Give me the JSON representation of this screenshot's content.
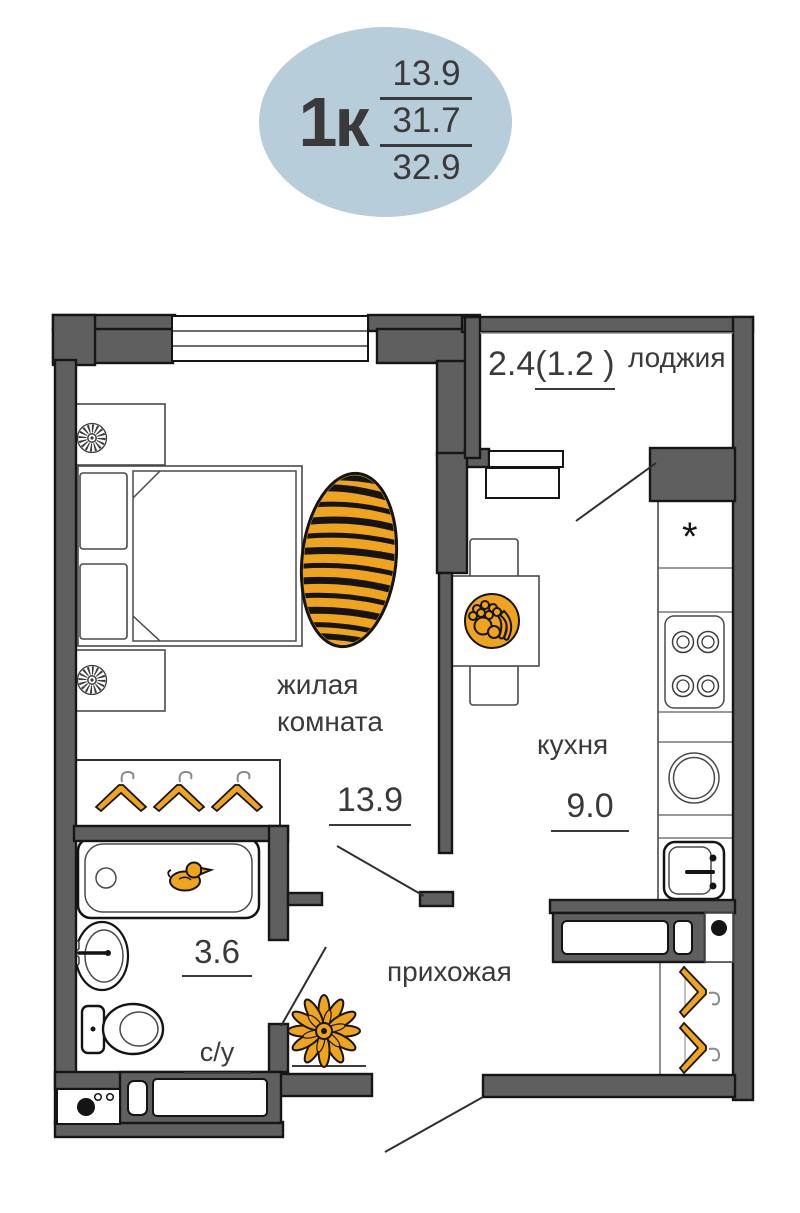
{
  "colors": {
    "badge_bg": "#b7cdd9",
    "text": "#3a3a3a",
    "wall": "#5f5f5f",
    "outline": "#161616",
    "accent_orange": "#f0a41e"
  },
  "badge": {
    "type_label": "1к",
    "area_lines": [
      "13.9",
      "31.7",
      "32.9"
    ]
  },
  "rooms": {
    "living": {
      "label": "жилая комната",
      "area": "13.9"
    },
    "kitchen": {
      "label": "кухня",
      "area": "9.0",
      "fridge_symbol": "*"
    },
    "loggia": {
      "label": "лоджия",
      "area_full": "2.4",
      "area_reduced": "(1.2 )"
    },
    "bathroom": {
      "label": "с/у",
      "area": "3.6"
    },
    "hallway": {
      "label": "прихожая"
    }
  }
}
